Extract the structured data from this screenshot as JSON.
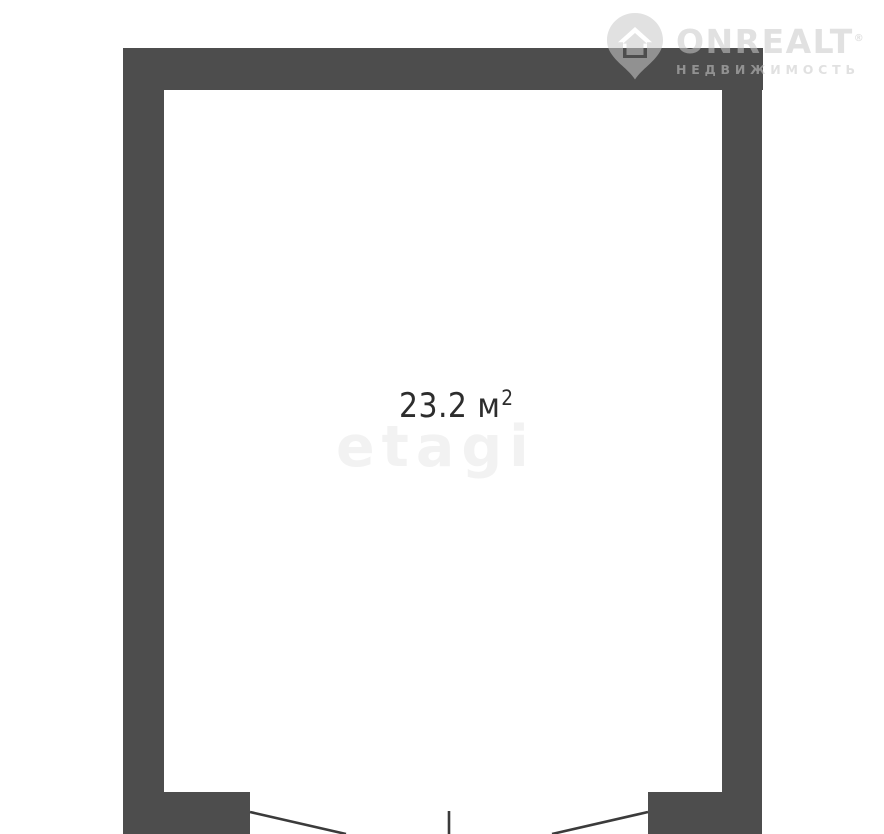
{
  "colors": {
    "wall": "#4d4d4d",
    "door-line": "#3b3b3b",
    "area-text": "#2d2d2d",
    "etagi-watermark": "#f2f2f2",
    "logo-gray": "#c9c9c9"
  },
  "floorplan": {
    "area": {
      "value": "23.2",
      "unit": " м",
      "exponent": "2"
    },
    "watermark": {
      "text": "etagi"
    }
  },
  "logo": {
    "brand": "ONREALT",
    "registered": "®",
    "subtitle": "НЕДВИЖИМОСТЬ",
    "icon": "location-pin-house-icon"
  }
}
